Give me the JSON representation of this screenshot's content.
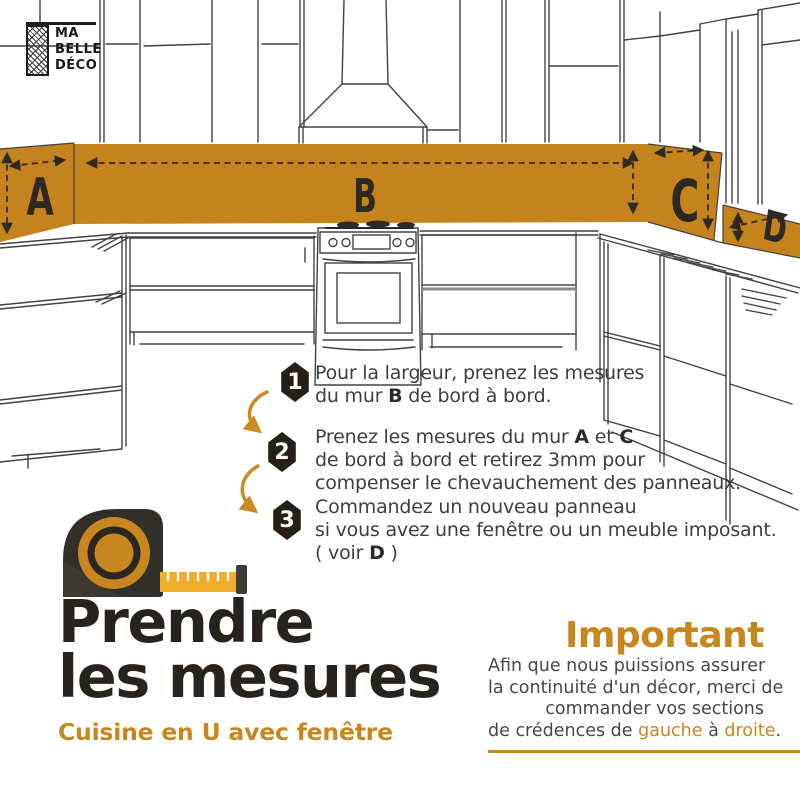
{
  "colors": {
    "accent": "#C8861E",
    "band": "#C5831D",
    "ink": "#2A241E",
    "hexagon": "#262019",
    "body_text": "#3E3E41"
  },
  "brand": {
    "line1": "MA",
    "line2": "BELLE",
    "line3": "DÉCO"
  },
  "diagram": {
    "wall_labels": {
      "a": "A",
      "b": "B",
      "c": "C",
      "d": "D"
    }
  },
  "steps": [
    {
      "number": "1",
      "line1": "Pour la largeur, prenez les mesures",
      "line2_pre": "du mur ",
      "line2_bold": "B",
      "line2_post": " de bord à bord."
    },
    {
      "number": "2",
      "line1_pre": "Prenez les mesures du mur ",
      "line1_bold1": "A",
      "line1_mid": " et ",
      "line1_bold2": "C",
      "line2": "de bord à bord et retirez 3mm pour",
      "line3": "compenser le chevauchement des panneaux."
    },
    {
      "number": "3",
      "line1": "Commandez un nouveau panneau",
      "line2": "si vous avez une fenêtre ou un meuble imposant.",
      "line3_pre": "( voir ",
      "line3_bold": "D",
      "line3_post": " )"
    }
  ],
  "title": {
    "line1": "Prendre",
    "line2": "les mesures",
    "subtitle": "Cuisine en U avec fenêtre"
  },
  "important": {
    "heading": "Important",
    "line1": "Afin que nous puissions assurer",
    "line2": "la continuité d'un décor, merci de",
    "line3": "commander vos sections",
    "line4_pre": "de crédences de ",
    "line4_accent1": "gauche",
    "line4_mid": " à ",
    "line4_accent2": "droite",
    "line4_end": "."
  }
}
